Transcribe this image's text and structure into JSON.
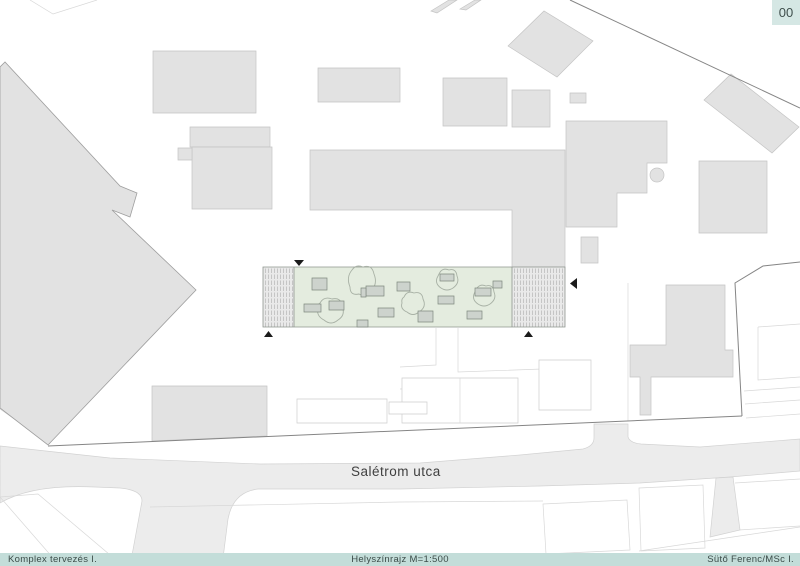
{
  "header": {
    "sheet_number": "00"
  },
  "footer": {
    "left": "Komplex tervezés I.",
    "center": "Helyszínrajz M=1:500",
    "right": "Sütő Ferenc/MSc I."
  },
  "colors": {
    "footer_bg": "#c3ddd9",
    "badge_bg": "#d5e7e4",
    "text_dark": "#3c4c49",
    "green_area": "#e4ecdf",
    "road": "#ececec",
    "building": "#e2e2e2"
  },
  "map": {
    "street_label": "Salétrom utca",
    "layers": [
      {
        "name": "roads",
        "shapes": [
          {
            "n": "road-saletrom-utca",
            "c": "road",
            "d": "M0,446 L110,458 L260,464 L420,463 L520,455 L583,449 Q594,446 594,438 L594,424 L628,424 L628,437 Q630,443 641,444 L700,447 L800,439 L800,471 L730,477 L640,483 L540,486 L400,489 L258,489 Q233,492 228,519 L222,566 L130,566 L142,501 Q142,490 120,488 L95,487 Q32,484 0,503 Z"
          },
          {
            "n": "road-alley",
            "c": "road",
            "d": "M716,478 L733,477 L740,530 L710,537 Z"
          }
        ]
      },
      {
        "name": "parcel-lines",
        "shapes": [
          {
            "n": "parcel-line",
            "c": "pline",
            "d": "M30,0 L53,14 L97,0"
          },
          {
            "n": "parcel-line",
            "c": "pline",
            "d": "M0,497 L38,494 L116,560 L60,566 Z"
          },
          {
            "n": "parcel-line",
            "c": "pline",
            "d": "M88,285 L0,300"
          },
          {
            "n": "parcel-line",
            "c": "pline",
            "d": "M50,444 L0,409"
          },
          {
            "n": "parcel-line",
            "c": "pline",
            "d": "M436,328 L436,365 L400,367"
          },
          {
            "n": "parcel-line",
            "c": "pline",
            "d": "M458,328 L458,372 L542,369"
          },
          {
            "n": "parcel-line",
            "c": "pline",
            "d": "M400,389 L436,388"
          },
          {
            "n": "parcel-line",
            "c": "pline",
            "d": "M150,507 L400,502 L543,501"
          },
          {
            "n": "parcel-line",
            "c": "pline",
            "d": "M543,504 L627,500 L630,550 L546,554 Z"
          },
          {
            "n": "parcel-line",
            "c": "pline",
            "d": "M639,488 L703,485 L705,548 L641,551 Z"
          },
          {
            "n": "parcel-line",
            "c": "pline",
            "d": "M735,483 L800,479 M739,530 L800,526"
          },
          {
            "n": "parcel-line",
            "c": "pline",
            "d": "M639,551 L800,527"
          },
          {
            "n": "parcel-line",
            "c": "pline",
            "d": "M744,391 L800,387 M745,404 L800,400 M746,418 L800,414"
          },
          {
            "n": "parcel-line",
            "c": "pline",
            "d": "M758,327 L800,324 M758,327 L758,380 L800,377"
          },
          {
            "n": "parcel-line",
            "c": "pline",
            "d": "M628,283 L628,421"
          }
        ]
      },
      {
        "name": "outlined-buildings",
        "shapes": [
          {
            "n": "building-outline",
            "c": "out",
            "d": "M402,378 H518 V423 H402 Z"
          },
          {
            "n": "building-outline-divider",
            "c": "pline",
            "d": "M460,378 V423"
          },
          {
            "n": "building-outline",
            "c": "out",
            "d": "M539,360 H591 V410 H539 Z"
          },
          {
            "n": "building-outline",
            "c": "out",
            "d": "M297,399 H387 V423 H297 Z"
          },
          {
            "n": "building-outline",
            "c": "out",
            "d": "M389,402 H427 V414 H389 Z"
          }
        ]
      },
      {
        "name": "buildings",
        "shapes": [
          {
            "n": "building-diagonal-block",
            "c": "bld2",
            "d": "M0,67 L5,62 L120,186 L137,193 L130,217 L112,210 L196,290 L48,445 L0,408 Z"
          },
          {
            "n": "building-footprint",
            "c": "bld",
            "d": "M153,51 H256 V113 H153 Z"
          },
          {
            "n": "building-footprint",
            "c": "bld",
            "d": "M190,127 H270 V147 H190 Z"
          },
          {
            "n": "building-footprint",
            "c": "bld",
            "d": "M192,147 H272 V209 H192 Z"
          },
          {
            "n": "building-footprint",
            "c": "bld",
            "d": "M178,148 H192 V160 H178 Z"
          },
          {
            "n": "building-footprint",
            "c": "bld",
            "d": "M318,68 H400 V102 H318 Z"
          },
          {
            "n": "building-footprint",
            "c": "bld",
            "d": "M508,46 L544,11 L593,41 L557,77 Z"
          },
          {
            "n": "building-footprint",
            "c": "bld",
            "d": "M431,11 L449,0 L457,0 L437,13 Z"
          },
          {
            "n": "building-footprint",
            "c": "bld",
            "d": "M460,9 L475,0 L481,0 L466,10 Z"
          },
          {
            "n": "building-footprint",
            "c": "bld",
            "d": "M443,78 H507 V126 H443 Z"
          },
          {
            "n": "building-footprint",
            "c": "bld",
            "d": "M512,90 H550 V127 H512 Z"
          },
          {
            "n": "building-footprint",
            "c": "bld",
            "d": "M570,93 H586 V103 H570 Z"
          },
          {
            "n": "building-footprint",
            "c": "bld",
            "d": "M566,121 H667 V163 H647 V193 H617 V227 H566 Z"
          },
          {
            "n": "building-footprint",
            "c": "bld",
            "d": "M699,161 H767 V233 H699 Z"
          },
          {
            "n": "building-footprint",
            "c": "bld",
            "d": "M704,100 L731,74 L799,127 L772,153 Z"
          },
          {
            "n": "building-footprint",
            "c": "bld",
            "d": "M581,237 H598 V263 H581 Z"
          },
          {
            "n": "building-footprint",
            "c": "bld",
            "d": "M310,150 H565 V267 H512 V210 H310 Z"
          },
          {
            "n": "building-footprint",
            "c": "bld",
            "d": "M152,386 H267 V436 L152,441 Z"
          },
          {
            "n": "building-footprint",
            "c": "bld",
            "d": "M666,285 H725 V350 H733 V377 H651 V415 H640 V377 H630 V345 H666 Z"
          },
          {
            "n": "round-feature",
            "c": "bld",
            "circle": [
              657,
              175,
              7
            ]
          }
        ]
      },
      {
        "name": "site-strip",
        "shapes": [
          {
            "n": "hatch-block-base",
            "c": "hbase",
            "d": "M263,267 H294 V327 H263 Z"
          },
          {
            "n": "hatch-block-base",
            "c": "hbase",
            "d": "M512,267 H565 V327 H512 Z"
          },
          {
            "n": "hatch-block",
            "c": "hatch",
            "d": "M263,267 H294 V327 H263 Z"
          },
          {
            "n": "hatch-block",
            "c": "hatch",
            "d": "M512,267 H565 V327 H512 Z"
          },
          {
            "n": "green-courtyard",
            "c": "green",
            "d": "M294,267 H512 V327 H294 Z"
          },
          {
            "n": "strip-border",
            "c": "stripb",
            "d": "M263,267 H565 V327 H263 Z M294,267 V327 M512,267 V327"
          }
        ]
      },
      {
        "name": "vegetation",
        "shapes": [
          {
            "n": "tree-canopy",
            "c": "tree",
            "d": "M352,270 Q356,264 363,267 Q372,264 374,274 Q378,284 371,291 Q366,298 359,294 Q350,296 350,287 Q346,277 352,270 Z"
          },
          {
            "n": "tree-canopy",
            "c": "tree",
            "d": "M404,297 Q407,290 414,293 Q422,291 423,299 Q427,307 419,312 Q413,317 407,312 Q400,309 402,303 Q401,299 404,297 Z"
          },
          {
            "n": "tree-canopy",
            "c": "tree",
            "d": "M320,303 Q324,296 332,299 Q341,297 342,306 Q346,315 338,320 Q331,326 324,320 Q316,316 318,308 Q318,304 320,303 Z"
          },
          {
            "n": "tree-canopy",
            "c": "tree",
            "d": "M439,274 Q442,267 449,270 Q456,268 457,276 Q460,283 453,288 Q447,292 441,288 Q435,284 437,278 Z"
          },
          {
            "n": "tree-canopy",
            "c": "tree",
            "d": "M476,290 Q479,283 486,286 Q493,284 494,292 Q497,299 490,304 Q484,308 478,304 Q472,300 474,294 Z"
          }
        ]
      },
      {
        "name": "furniture",
        "shapes": [
          {
            "n": "furniture-item",
            "c": "furn",
            "d": "M312,278 h15 v12 h-15 Z"
          },
          {
            "n": "furniture-item",
            "c": "furn",
            "d": "M366,286 h18 v10 h-18 Z"
          },
          {
            "n": "furniture-item",
            "c": "furn",
            "d": "M361,288 h5 v9 h-5 Z"
          },
          {
            "n": "furniture-item",
            "c": "furn",
            "d": "M397,282 h13 v9 h-13 Z"
          },
          {
            "n": "furniture-item",
            "c": "furn",
            "d": "M304,304 h17 v8 h-17 Z"
          },
          {
            "n": "furniture-item",
            "c": "furn",
            "d": "M329,301 h15 v9 h-15 Z"
          },
          {
            "n": "furniture-item",
            "c": "furn",
            "d": "M378,308 h16 v9 h-16 Z"
          },
          {
            "n": "furniture-item",
            "c": "furn",
            "d": "M418,311 h15 v11 h-15 Z"
          },
          {
            "n": "furniture-item",
            "c": "furn",
            "d": "M438,296 h16 v8 h-16 Z"
          },
          {
            "n": "furniture-item",
            "c": "furn",
            "d": "M440,274 h14 v7 h-14 Z"
          },
          {
            "n": "furniture-item",
            "c": "furn",
            "d": "M475,288 h16 v8 h-16 Z"
          },
          {
            "n": "furniture-item",
            "c": "furn",
            "d": "M467,311 h15 v8 h-15 Z"
          },
          {
            "n": "furniture-item",
            "c": "furn",
            "d": "M357,320 h11 v7 h-11 Z"
          },
          {
            "n": "furniture-item",
            "c": "furn",
            "d": "M493,281 h9 v7 h-9 Z"
          }
        ]
      },
      {
        "name": "markers",
        "shapes": [
          {
            "n": "entrance-arrow",
            "c": "mark",
            "d": "M294,260 L304,260 L299,266 Z"
          },
          {
            "n": "entrance-arrow",
            "c": "mark",
            "d": "M264,337 L273,337 L268.5,331 Z"
          },
          {
            "n": "entrance-arrow",
            "c": "mark",
            "d": "M524,337 L533,337 L528.5,331 Z"
          },
          {
            "n": "entrance-arrow",
            "c": "mark",
            "d": "M577,278 L577,289 L570,283.5 Z"
          }
        ]
      },
      {
        "name": "boundary-lines",
        "shapes": [
          {
            "n": "site-boundary",
            "c": "bline",
            "d": "M48,446 L742,416"
          },
          {
            "n": "site-boundary",
            "c": "bline",
            "d": "M742,416 L735,283 L763,266 L800,262"
          },
          {
            "n": "site-boundary",
            "c": "bline",
            "d": "M570,0 L800,108"
          }
        ]
      }
    ]
  }
}
